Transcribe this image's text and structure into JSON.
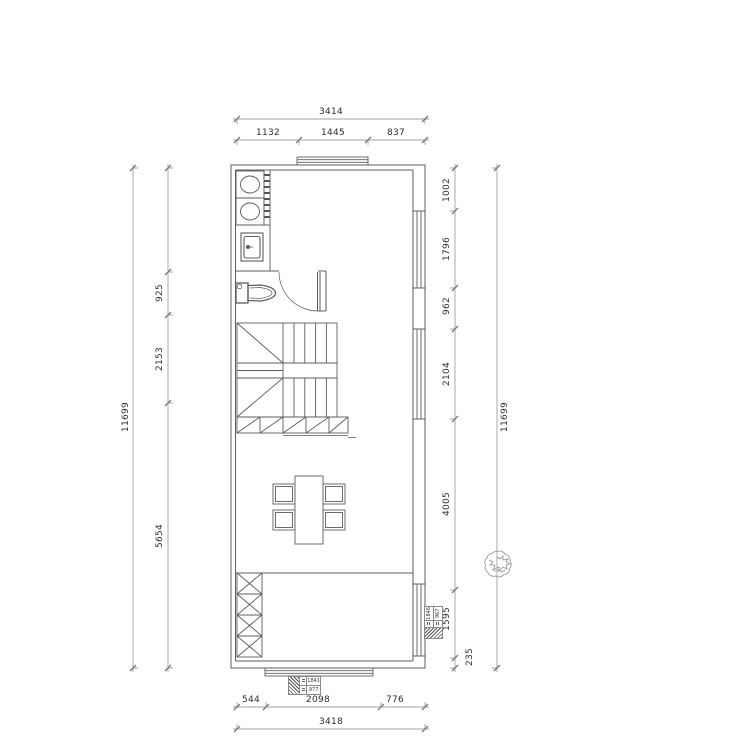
{
  "dimensions": {
    "top": {
      "total": "3414",
      "seg1": "1132",
      "seg2": "1445",
      "seg3": "837"
    },
    "bottom": {
      "seg1": "544",
      "seg2": "2098",
      "seg3": "776",
      "total": "3418"
    },
    "left": {
      "total": "11699",
      "seg1": "925",
      "seg2": "2153",
      "seg3": "5654"
    },
    "right": {
      "total": "11699",
      "seg1": "1002",
      "seg2": "1796",
      "seg3": "962",
      "seg4": "2104",
      "seg5": "4005",
      "seg6": "1595",
      "seg7": "235"
    }
  },
  "tags": {
    "bottom_window": {
      "value1": "1841",
      "value2": "977"
    },
    "right_window": {
      "value1": "1846",
      "value2": "967"
    }
  },
  "symbols": {
    "tree": "plant-scribble-icon",
    "washing_machine": "ellipse-drum-icon",
    "toilet": "toilet-plan-icon",
    "door": "quarter-arc-door-swing"
  },
  "colors": {
    "plan_line": "#5d5d5d",
    "dim_line": "#a2a2a2",
    "tick": "#787878",
    "text": "#2d2d2d",
    "background": "#ffffff"
  }
}
